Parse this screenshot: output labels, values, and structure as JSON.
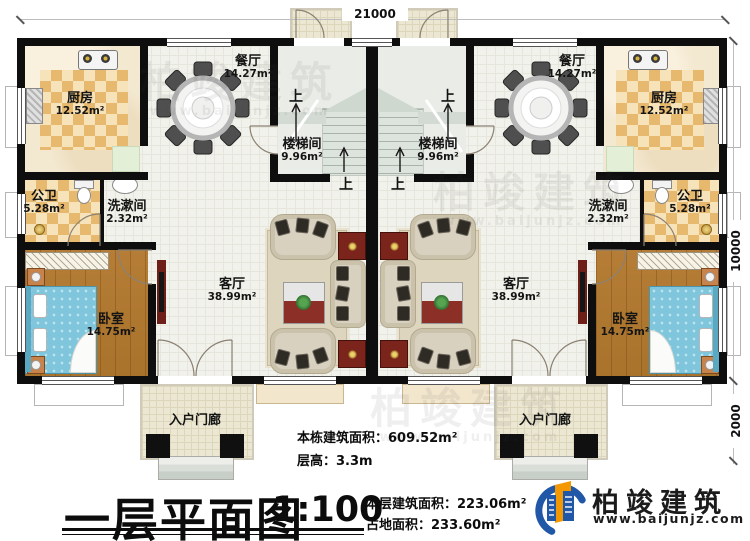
{
  "plan": {
    "dimensions": {
      "width_total": "21000",
      "depth_main": "10000",
      "porch_depth": "2000"
    },
    "rooms": {
      "kitchen": {
        "label": "厨房",
        "area": "12.52m²"
      },
      "dining": {
        "label": "餐厅",
        "area": "14.27m²"
      },
      "stairwell": {
        "label": "楼梯间",
        "area": "9.96m²"
      },
      "bathroom": {
        "label": "公卫",
        "area": "5.28m²"
      },
      "washroom": {
        "label": "洗漱间",
        "area": "2.32m²"
      },
      "living": {
        "label": "客厅",
        "area": "38.99m²"
      },
      "bedroom": {
        "label": "卧室",
        "area": "14.75m²"
      },
      "porch": {
        "label": "入户门廊"
      }
    },
    "stairs": {
      "up": "上"
    }
  },
  "title_block": {
    "title": "一层平面图",
    "scale": "1:100",
    "building_total_area": "本栋建筑面积：609.52m²",
    "floor_height": "层高：3.3m",
    "floor_area": "本层建筑面积：223.06m²",
    "footprint_area": "占地面积：233.60m²"
  },
  "branding": {
    "name": "柏竣建筑",
    "website": "www.baijunjz.com"
  },
  "watermark": {
    "name": "柏竣建筑",
    "website": "www.baijunjz.com"
  },
  "colors": {
    "wall": "#0e0e0e",
    "floor_tile": "#f2f2ec",
    "checker_tan": "#e7b96e",
    "wood": "#b0772f",
    "bed_blue": "#7fc6dc",
    "sofa_beige": "#d9d1c0",
    "cabinet_red": "#7b241c",
    "logo_blue": "#2057a7",
    "logo_orange": "#f39800"
  }
}
